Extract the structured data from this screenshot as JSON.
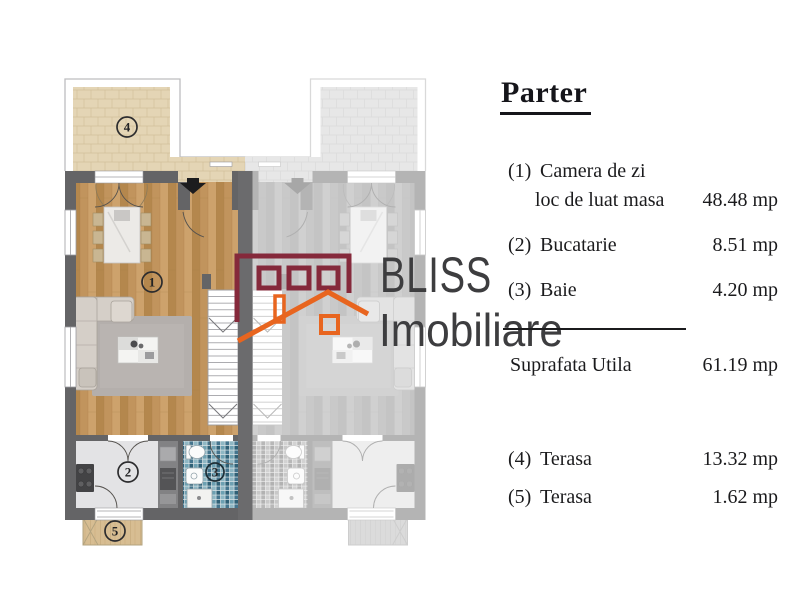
{
  "title": "Parter",
  "legend": {
    "rows": [
      {
        "num": "(1)",
        "label": "Camera de zi",
        "label2": "loc de luat masa",
        "value": "48.48 mp"
      },
      {
        "num": "(2)",
        "label": "Bucatarie",
        "value": "8.51 mp"
      },
      {
        "num": "(3)",
        "label": "Baie",
        "value": "4.20 mp"
      }
    ],
    "total": {
      "label": "Suprafata Utila",
      "value": "61.19 mp"
    },
    "rows2": [
      {
        "num": "(4)",
        "label": "Terasa",
        "value": "13.32 mp"
      },
      {
        "num": "(5)",
        "label": "Terasa",
        "value": "1.62 mp"
      }
    ]
  },
  "logo": {
    "brand": "BLISS",
    "sub": "Imobiliare",
    "maroon": "#85293b",
    "orange": "#e8651f",
    "text_color": "#3d3d3f"
  },
  "plan": {
    "labels": {
      "living": "1",
      "kitchen": "2",
      "bath": "3",
      "terrace_top": "4",
      "terrace_bottom": "5"
    }
  },
  "colors": {
    "wall": "#646466",
    "party_wall": "#6b6b6d",
    "wood_base": "#c2955e",
    "tile_beige": "#e4d5b5",
    "mosaic_blue": "#4e8199",
    "legend_text": "#1b1b1d"
  }
}
